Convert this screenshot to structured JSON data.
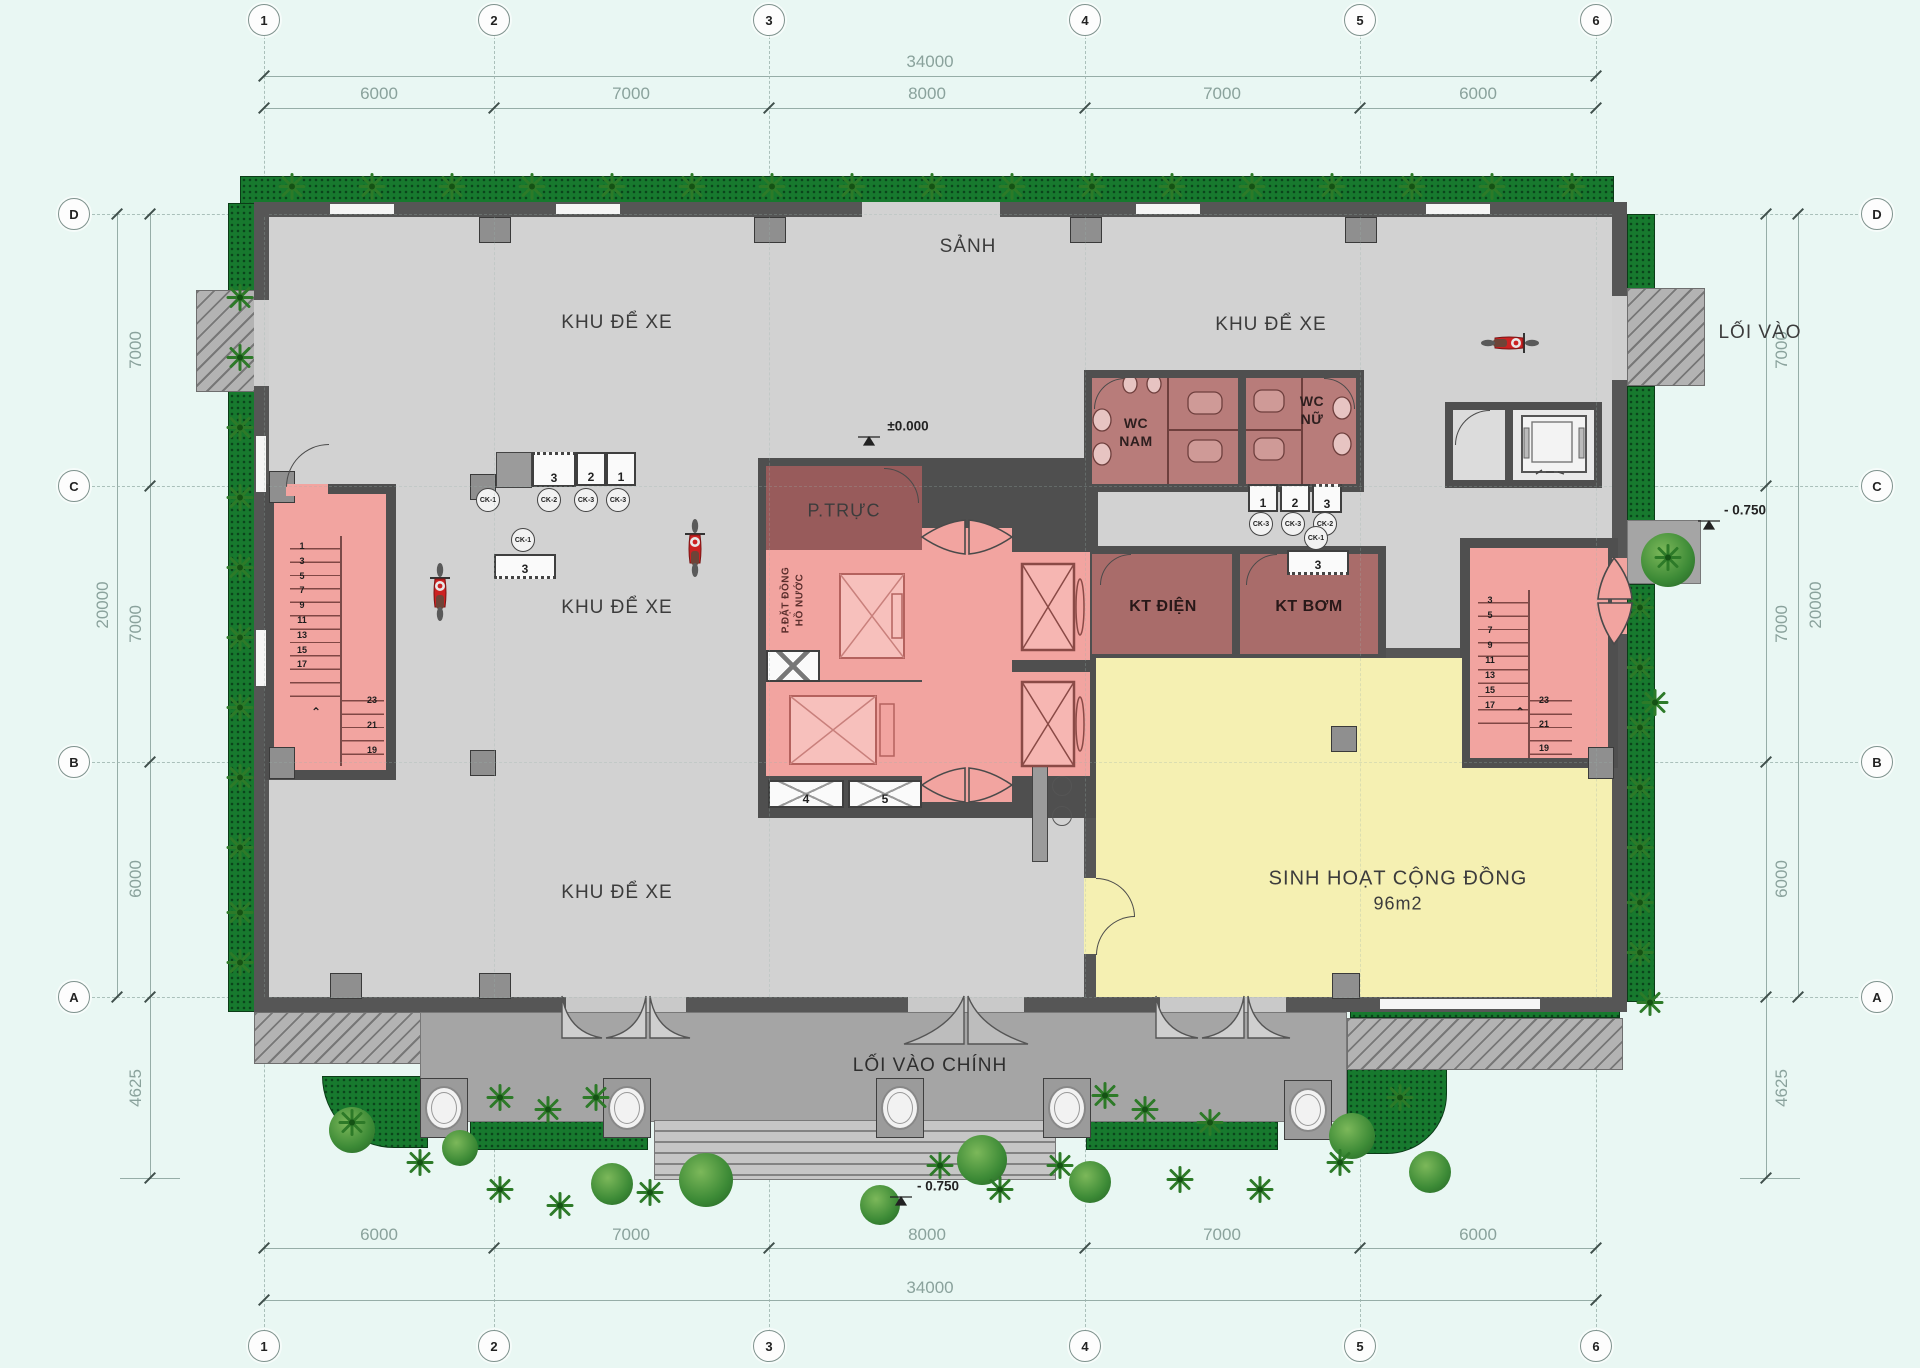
{
  "meta": {
    "drawing_type": "architectural floor plan",
    "floor": "ground floor"
  },
  "colors": {
    "background": "#e9f7f3",
    "floor": "#d2d2d2",
    "wall": "#565656",
    "stair_pink": "#f2a4a0",
    "duty_red": "#985b5b",
    "wc_red": "#b87c7a",
    "kt_red": "#a96c6a",
    "community_yellow": "#f5f0b2",
    "hedge_green": "#17792e",
    "terrace_gray": "#a5a5a5",
    "accent_moto": "#cc2222"
  },
  "grid": {
    "cols": [
      "1",
      "2",
      "3",
      "4",
      "5",
      "6"
    ],
    "rows": [
      "D",
      "C",
      "B",
      "A"
    ]
  },
  "dimensions": {
    "overall_width": "34000",
    "width_segments": [
      "6000",
      "7000",
      "8000",
      "7000",
      "6000"
    ],
    "overall_depth": "20000",
    "depth_segments": [
      "7000",
      "7000",
      "6000"
    ],
    "front_apron": "4625"
  },
  "levels": {
    "ground": "±0.000",
    "entry": "- 0.750"
  },
  "rooms": {
    "hall": "SẢNH",
    "parking": "KHU ĐỂ XE",
    "wc_men_1": "WC",
    "wc_men_2": "NAM",
    "wc_women_1": "WC",
    "wc_women_2": "NỮ",
    "duty": "P.TRỰC",
    "water_meter_1": "P.ĐẶT ĐỒNG",
    "water_meter_2": "HỒ NƯỚC",
    "electrical": "KT ĐIỆN",
    "pump": "KT BƠM",
    "community": "SINH HOẠT CỘNG ĐỒNG",
    "community_area": "96m2",
    "side_entrance": "LỐI VÀO",
    "main_entrance": "LỐI VÀO CHÍNH"
  },
  "stairs": {
    "flight_numbers_left": [
      "1",
      "3",
      "5",
      "7",
      "9",
      "11",
      "13",
      "15",
      "17"
    ],
    "flight_numbers_right": [
      "3",
      "5",
      "7",
      "9",
      "11",
      "13",
      "15",
      "17"
    ],
    "upper_numbers": [
      "23",
      "21",
      "19"
    ]
  },
  "equipment": {
    "counter_cells": [
      "3",
      "2",
      "1"
    ],
    "counter_marks": [
      "CK-2",
      "CK-3",
      "CK-3"
    ],
    "wc_cells": [
      "1",
      "2",
      "3"
    ],
    "wc_marks": [
      "CK-3",
      "CK-3",
      "CK-2"
    ],
    "single_mark": "CK-1",
    "trough_label": "3",
    "lift_pit_cells": [
      "4",
      "5"
    ]
  }
}
